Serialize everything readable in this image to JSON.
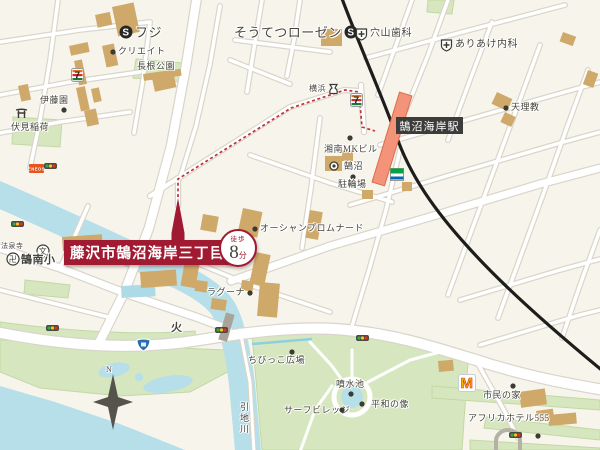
{
  "main_label": {
    "text": "藤沢市鵠沼海岸三丁目",
    "walk_prefix": "徒歩",
    "walk_number": "8",
    "walk_suffix": "分"
  },
  "station": {
    "name": "鵠沼海岸駅"
  },
  "colors": {
    "accent_red": "#a01b31",
    "route_dotted": "#bf3434",
    "rail": "#1d1d1b",
    "station_fill": "#f2937a",
    "water": "#b7dfe9",
    "park": "#d6e7bf",
    "building": "#cfa969",
    "road_casing": "#d8d5ca",
    "background": "#f7f4ec",
    "label_bg": "#3c3c3b"
  },
  "markers": [
    {
      "name": "supermarket-fuji",
      "icon": "s-circle",
      "label": "フジ",
      "x": 119,
      "y": 25,
      "fs": 13
    },
    {
      "name": "create-drugstore",
      "icon": "dot",
      "label": "クリエイト",
      "x": 110,
      "y": 47,
      "fs": 9
    },
    {
      "name": "takane-park",
      "label": "長根公園",
      "x": 137,
      "y": 62,
      "fs": 9
    },
    {
      "name": "sotetsu-rosen",
      "label": "そうてつローゼン",
      "icon2": "s-circle",
      "x": 234,
      "y": 25,
      "fs": 13
    },
    {
      "name": "anayama-dental",
      "icon": "hospital",
      "label": "穴山歯科",
      "x": 355,
      "y": 27,
      "fs": 10
    },
    {
      "name": "ariake-clinic",
      "icon": "hospital",
      "label": "ありあけ内科",
      "x": 440,
      "y": 38,
      "fs": 10
    },
    {
      "name": "tenrikyo",
      "icon": "dot",
      "label": "天理教",
      "x": 503,
      "y": 103,
      "fs": 9
    },
    {
      "name": "yokohama-bank",
      "label": "横浜",
      "icon2": "bank",
      "x": 309,
      "y": 83,
      "fs": 8
    },
    {
      "name": "seven-eleven-north",
      "icon": "seven",
      "x": 71,
      "y": 68
    },
    {
      "name": "seven-eleven-station",
      "icon": "seven",
      "x": 350,
      "y": 93
    },
    {
      "name": "shonan-mk-dot",
      "icon": "dot",
      "x": 347,
      "y": 135
    },
    {
      "name": "shonan-mk-bldg",
      "label": "湘南MKビル",
      "x": 324,
      "y": 145,
      "fs": 9
    },
    {
      "name": "kugenuma-post",
      "icon": "ring-dot",
      "x": 329,
      "y": 161
    },
    {
      "name": "kugenuma",
      "label": "鵠沼",
      "x": 344,
      "y": 162,
      "fs": 9
    },
    {
      "name": "bicycle-dot",
      "icon": "dot",
      "x": 350,
      "y": 174
    },
    {
      "name": "bicycle-parking",
      "label": "駐輪場",
      "x": 338,
      "y": 180,
      "fs": 9
    },
    {
      "name": "familymart",
      "icon": "familymart",
      "x": 390,
      "y": 168
    },
    {
      "name": "ocean-promenade",
      "icon": "dot",
      "label": "オーシャンプロムナード",
      "x": 252,
      "y": 224,
      "fs": 9
    },
    {
      "name": "laguna",
      "label": "ラグーナ",
      "icon2": "dot",
      "x": 207,
      "y": 288,
      "fs": 9
    },
    {
      "name": "kunan-elem-icon",
      "icon": "school",
      "x": 36,
      "y": 244
    },
    {
      "name": "kunan-elementary",
      "label": "鵠南小",
      "x": 21,
      "y": 255,
      "fs": 11,
      "bold": true
    },
    {
      "name": "hosenji-temple-icon",
      "icon": "temple",
      "x": 6,
      "y": 252
    },
    {
      "name": "hosenji-temple",
      "label": "法泉寺",
      "x": 1,
      "y": 243,
      "fs": 7
    },
    {
      "name": "fushimi-inari-icon",
      "icon": "torii",
      "x": 15,
      "y": 107
    },
    {
      "name": "fushimi-inari",
      "label": "伏見稲荷",
      "x": 11,
      "y": 123,
      "fs": 9
    },
    {
      "name": "itoen",
      "label": "伊藤園",
      "x": 40,
      "y": 96,
      "fs": 9
    },
    {
      "name": "itoen-dot",
      "icon": "dot",
      "x": 61,
      "y": 107
    },
    {
      "name": "eneos",
      "icon": "eneos",
      "x": 29,
      "y": 164
    },
    {
      "name": "signal-1",
      "icon": "traffic",
      "x": 44,
      "y": 163
    },
    {
      "name": "signal-2",
      "icon": "traffic",
      "x": 11,
      "y": 221
    },
    {
      "name": "signal-3",
      "icon": "traffic",
      "x": 46,
      "y": 325
    },
    {
      "name": "signal-4",
      "icon": "traffic",
      "x": 215,
      "y": 327
    },
    {
      "name": "signal-5",
      "icon": "traffic",
      "x": 356,
      "y": 335
    },
    {
      "name": "signal-6",
      "icon": "traffic",
      "x": 509,
      "y": 432
    },
    {
      "name": "fire-mark",
      "label": "火",
      "x": 171,
      "y": 323,
      "fs": 11,
      "bold": true
    },
    {
      "name": "route-shield",
      "icon": "shield",
      "x": 136,
      "y": 338
    },
    {
      "name": "compass-n-label",
      "label": "N",
      "x": 106,
      "y": 366,
      "fs": 8
    },
    {
      "name": "chibikko-dot",
      "icon": "dot",
      "x": 289,
      "y": 349
    },
    {
      "name": "chibikko-plaza",
      "label": "ちびっこ広場",
      "x": 248,
      "y": 356,
      "fs": 9
    },
    {
      "name": "fountain-pond",
      "label": "噴水池",
      "x": 336,
      "y": 380,
      "fs": 9
    },
    {
      "name": "fountain-dot",
      "icon": "dot",
      "x": 348,
      "y": 391
    },
    {
      "name": "peace-dot",
      "icon": "dot",
      "x": 359,
      "y": 401
    },
    {
      "name": "peace-statue",
      "label": "平和の像",
      "x": 371,
      "y": 400,
      "fs": 9
    },
    {
      "name": "surf-village",
      "label": "サーフビレッジ",
      "x": 284,
      "y": 406,
      "fs": 9
    },
    {
      "name": "surf-dot",
      "icon": "dot",
      "x": 339,
      "y": 407
    },
    {
      "name": "mcdonalds",
      "icon": "mcdonalds",
      "x": 458,
      "y": 374
    },
    {
      "name": "shimin-dot",
      "icon": "dot",
      "x": 510,
      "y": 383
    },
    {
      "name": "shimin-no-ie",
      "label": "市民の家",
      "x": 483,
      "y": 391,
      "fs": 9
    },
    {
      "name": "africa-hotel",
      "label": "アフリカホテル555",
      "x": 468,
      "y": 414,
      "fs": 9
    },
    {
      "name": "africa-dot",
      "icon": "dot",
      "x": 535,
      "y": 433
    },
    {
      "name": "hikichi-river",
      "label": "引地川",
      "x": 239,
      "y": 402,
      "fs": 9,
      "vertical": true
    }
  ]
}
